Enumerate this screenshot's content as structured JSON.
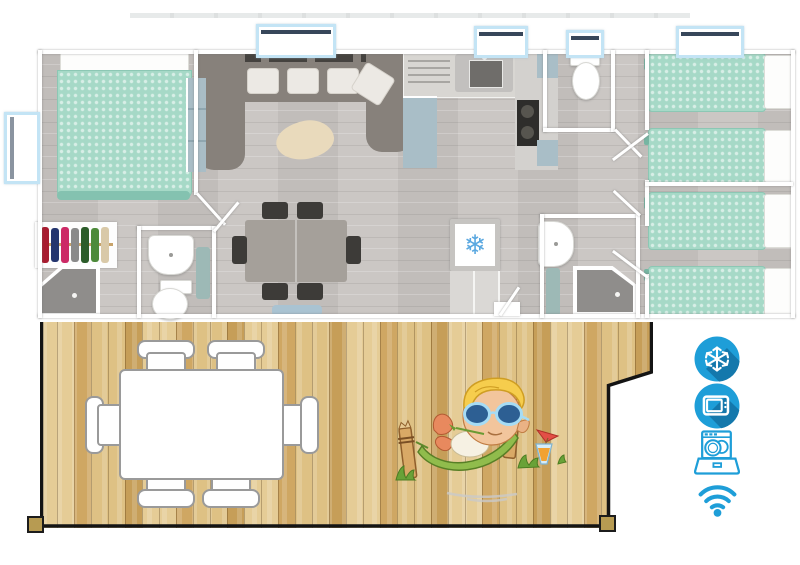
{
  "scene": {
    "description": "Top-down 3D floor plan of a mobile home with wooden terrace",
    "fridge_glyph": "❄"
  },
  "colors": {
    "amenity_blue": "#1E9ED8",
    "amenity_blue_shadow": "#1478AC",
    "bedding_teal": "#A6D9C7",
    "deck_wood_tan": "#D9BB7E",
    "floor_wood_gray": "#C8C4C1",
    "sofa_gray": "#87817B",
    "rug_beige": "#E9DABC",
    "window_frame_blue": "#C3E4F5",
    "fridge_snowflake_blue": "#5BA8E0"
  },
  "floorplan": {
    "rooms": [
      "master-bedroom",
      "living-room",
      "kitchen",
      "wc",
      "hallway",
      "twin-bedroom-1",
      "twin-bedroom-2",
      "shower-room",
      "entry"
    ],
    "furniture": {
      "double_beds": 1,
      "single_beds": 4,
      "sofa": "U-shaped corner sofa with cushions",
      "dining_seats_inside": 6,
      "wardrobe_with_clothes": 1,
      "toilets": 2,
      "showers": 2,
      "washbasins": 2,
      "fridge_with_snowflake": 1,
      "kitchen": [
        "sink",
        "drainboard",
        "hob",
        "cabinets"
      ]
    }
  },
  "deck": {
    "table": "white rectangular table",
    "deck_seats": 6,
    "mascot": "elf character relaxing in hammock with cocktail"
  },
  "amenities": [
    {
      "icon": "snowflake-icon"
    },
    {
      "icon": "tv-icon"
    },
    {
      "icon": "dishwasher-icon"
    },
    {
      "icon": "wifi-icon"
    }
  ]
}
